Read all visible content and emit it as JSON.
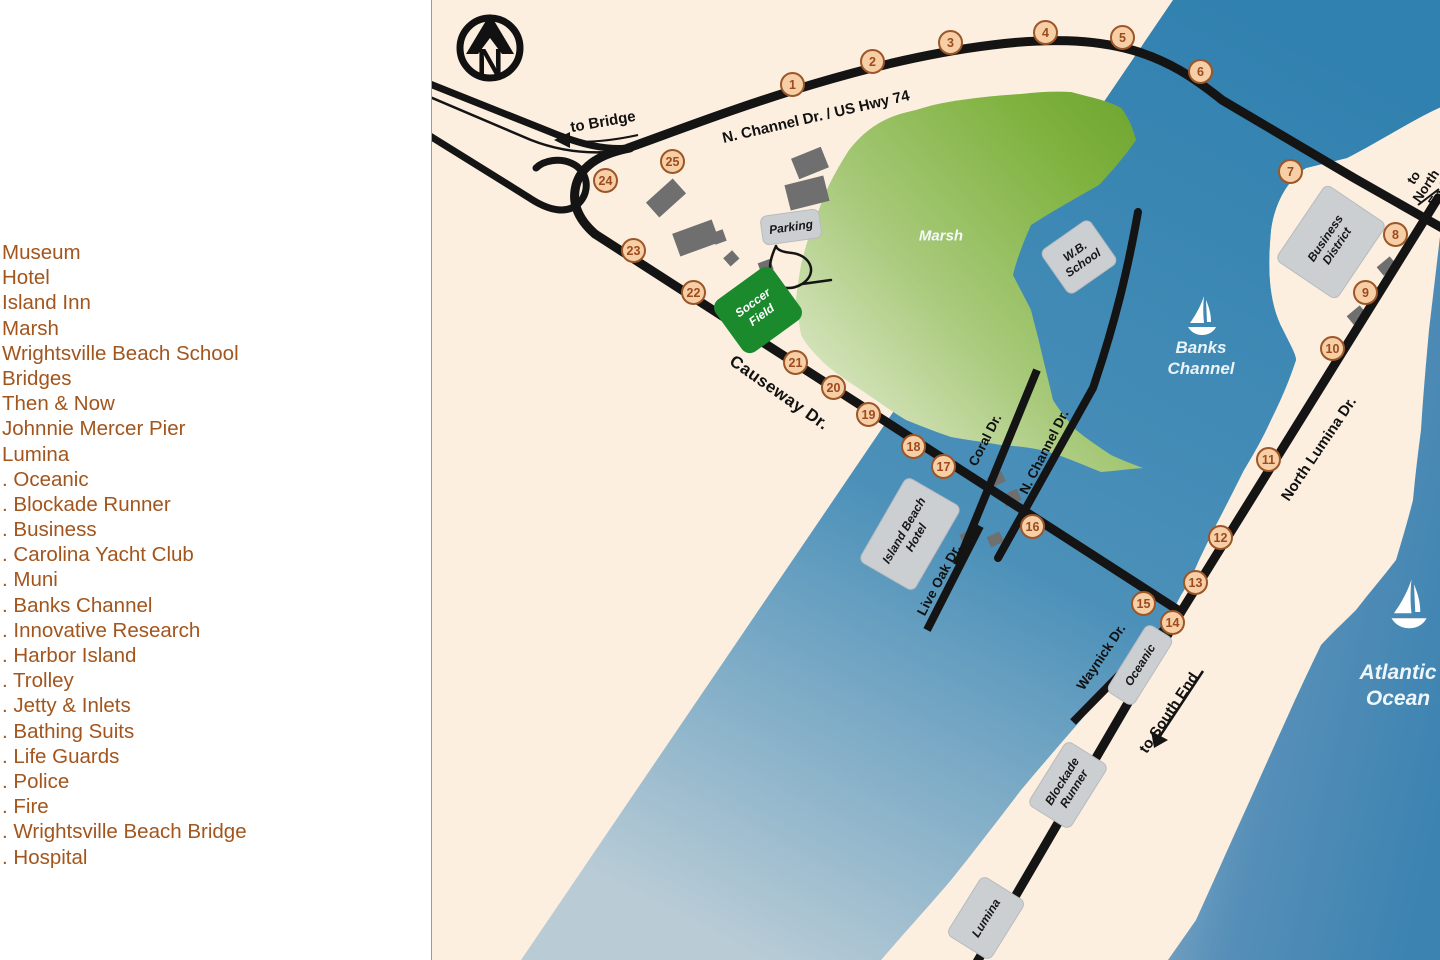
{
  "legend": {
    "items": [
      "Museum",
      "Hotel",
      "Island Inn",
      "Marsh",
      "Wrightsville Beach School",
      "Bridges",
      "Then & Now",
      "Johnnie Mercer Pier",
      "Lumina",
      ". Oceanic",
      ". Blockade Runner",
      ". Business",
      ". Carolina Yacht Club",
      ". Muni",
      ". Banks Channel",
      ". Innovative Research",
      ". Harbor Island",
      ". Trolley",
      ". Jetty & Inlets",
      ". Bathing Suits",
      ". Life Guards",
      ". Police",
      ". Fire",
      ". Wrightsville Beach Bridge",
      ". Hospital"
    ],
    "text_color": "#a2551c"
  },
  "map": {
    "compass_letter": "N",
    "colors": {
      "land": "#fcefe0",
      "water_deep": "#2e7dad",
      "water_light": "#b9ccd6",
      "marsh_dark": "#6ea42f",
      "marsh_light": "#eef2e0",
      "soccer_field": "#1b8a2d",
      "road": "#141414",
      "marker_fill": "#f6cfa6",
      "marker_ring": "#9c5627",
      "building_gray": "#6f6f6f"
    },
    "soccer_field_label": "Soccer\nField",
    "markers": [
      {
        "n": "1",
        "x": 361,
        "y": 85
      },
      {
        "n": "2",
        "x": 441,
        "y": 62
      },
      {
        "n": "3",
        "x": 519,
        "y": 43
      },
      {
        "n": "4",
        "x": 614,
        "y": 33
      },
      {
        "n": "5",
        "x": 691,
        "y": 38
      },
      {
        "n": "6",
        "x": 769,
        "y": 72
      },
      {
        "n": "7",
        "x": 859,
        "y": 172
      },
      {
        "n": "8",
        "x": 964,
        "y": 235
      },
      {
        "n": "9",
        "x": 934,
        "y": 293
      },
      {
        "n": "10",
        "x": 901,
        "y": 349
      },
      {
        "n": "11",
        "x": 837,
        "y": 460
      },
      {
        "n": "12",
        "x": 789,
        "y": 538
      },
      {
        "n": "13",
        "x": 764,
        "y": 583
      },
      {
        "n": "14",
        "x": 741,
        "y": 623
      },
      {
        "n": "15",
        "x": 712,
        "y": 604
      },
      {
        "n": "16",
        "x": 601,
        "y": 527
      },
      {
        "n": "17",
        "x": 512,
        "y": 467
      },
      {
        "n": "18",
        "x": 482,
        "y": 447
      },
      {
        "n": "19",
        "x": 437,
        "y": 415
      },
      {
        "n": "20",
        "x": 402,
        "y": 388
      },
      {
        "n": "21",
        "x": 364,
        "y": 363
      },
      {
        "n": "22",
        "x": 262,
        "y": 293
      },
      {
        "n": "23",
        "x": 202,
        "y": 251
      },
      {
        "n": "24",
        "x": 174,
        "y": 181
      },
      {
        "n": "25",
        "x": 241,
        "y": 162
      }
    ],
    "labels": [
      {
        "text": "N. Channel Dr. / US Hwy 74",
        "x": 384,
        "y": 117,
        "rot": -13,
        "cls": "road-lg",
        "name": "road-label-n-channel-hwy74"
      },
      {
        "text": "to Bridge",
        "x": 171,
        "y": 122,
        "rot": -10,
        "cls": "road-lg",
        "name": "to-bridge-label"
      },
      {
        "text": "Causeway Dr.",
        "x": 347,
        "y": 393,
        "rot": 35,
        "cls": "road-xl",
        "name": "road-label-causeway"
      },
      {
        "text": "Coral Dr.",
        "x": 553,
        "y": 440,
        "rot": -63,
        "cls": "road-md",
        "name": "road-label-coral"
      },
      {
        "text": "N. Channel Dr.",
        "x": 612,
        "y": 452,
        "rot": -63,
        "cls": "road-md",
        "name": "road-label-n-channel"
      },
      {
        "text": "Live Oak Dr.",
        "x": 507,
        "y": 580,
        "rot": -62,
        "cls": "road-md",
        "name": "road-label-live-oak"
      },
      {
        "text": "North Lumina Dr.",
        "x": 887,
        "y": 449,
        "rot": -56,
        "cls": "road-lg",
        "name": "road-label-north-lumina"
      },
      {
        "text": "Waynick Dr.",
        "x": 669,
        "y": 657,
        "rot": -56,
        "cls": "road-md",
        "name": "road-label-waynick"
      },
      {
        "text": "to South End",
        "x": 737,
        "y": 713,
        "rot": -56,
        "cls": "road-lg",
        "name": "to-south-end-label"
      },
      {
        "text": "to North End",
        "x": 994,
        "y": 186,
        "rot": -56,
        "cls": "road-md",
        "name": "to-north-end-label"
      },
      {
        "text": "Marsh",
        "x": 509,
        "y": 236,
        "rot": 0,
        "cls": "water-md",
        "name": "marsh-label"
      },
      {
        "text": "Banks\nChannel",
        "x": 769,
        "y": 358,
        "rot": 0,
        "cls": "water-lg",
        "name": "banks-channel-label"
      },
      {
        "text": "Atlantic\nOcean",
        "x": 966,
        "y": 686,
        "rot": 0,
        "cls": "water-xl",
        "name": "atlantic-ocean-label"
      }
    ],
    "buildings": [
      {
        "label": "Parking",
        "x": 358,
        "y": 226,
        "w": 58,
        "h": 28,
        "rot": -8,
        "name": "parking-building"
      },
      {
        "label": "W.B.\nSchool",
        "x": 646,
        "y": 256,
        "w": 58,
        "h": 52,
        "rot": -35,
        "name": "wb-school-building"
      },
      {
        "label": "Business\nDistrict",
        "x": 898,
        "y": 241,
        "w": 90,
        "h": 72,
        "rot": -56,
        "name": "business-district-building"
      },
      {
        "label": "Island Beach\nHotel",
        "x": 477,
        "y": 533,
        "w": 96,
        "h": 62,
        "rot": -60,
        "name": "island-beach-hotel-building"
      },
      {
        "label": "Oceanic",
        "x": 707,
        "y": 664,
        "w": 78,
        "h": 30,
        "rot": -58,
        "name": "oceanic-building"
      },
      {
        "label": "Blockade\nRunner",
        "x": 635,
        "y": 784,
        "w": 74,
        "h": 48,
        "rot": -58,
        "name": "blockade-runner-building"
      },
      {
        "label": "Lumina",
        "x": 553,
        "y": 917,
        "w": 68,
        "h": 50,
        "rot": -58,
        "name": "lumina-building"
      }
    ]
  }
}
